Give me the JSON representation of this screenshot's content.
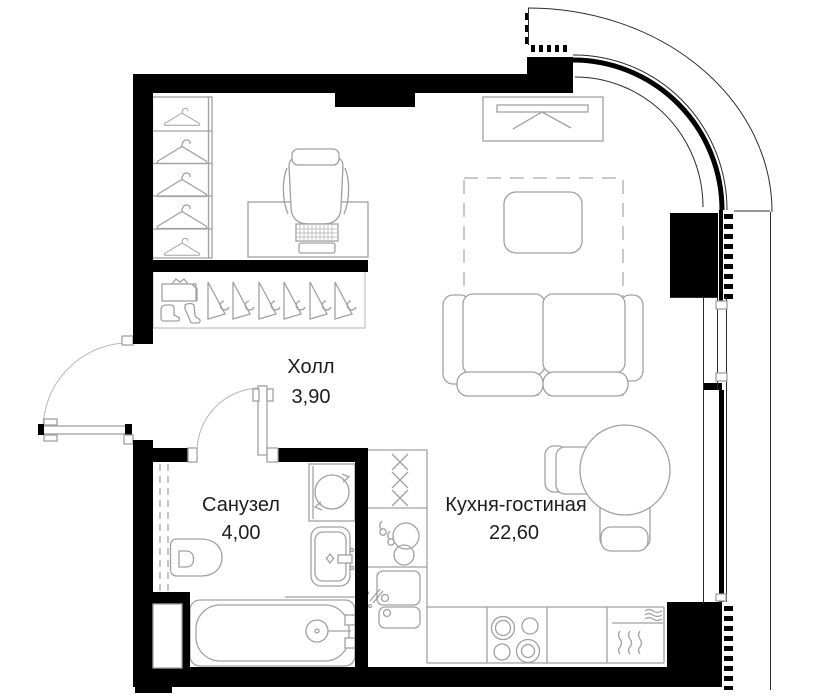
{
  "plan": {
    "rooms": [
      {
        "key": "hall",
        "name": "Холл",
        "area": "3,90"
      },
      {
        "key": "bathroom",
        "name": "Санузел",
        "area": "4,00"
      },
      {
        "key": "kitchen_living",
        "name": "Кухня-гостиная",
        "area": "22,60"
      }
    ],
    "colors": {
      "walls": "#000000",
      "furniture_outline": "#a0a0a0",
      "carpet_outline": "#c9c9c9",
      "label_text": "#1d1d1d",
      "background": "#ffffff"
    }
  }
}
